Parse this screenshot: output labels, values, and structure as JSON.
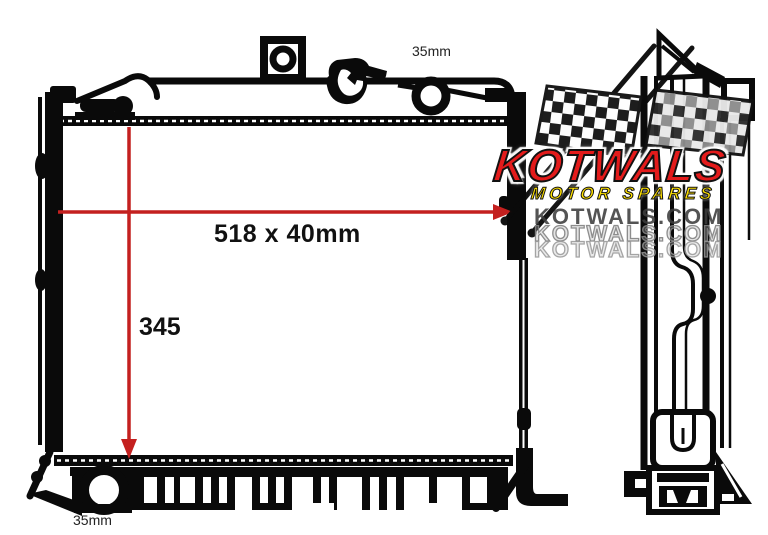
{
  "page": {
    "background": "#ffffff"
  },
  "diagram": {
    "subject": "Radiator technical line drawing, front and side views",
    "labels": {
      "core_size": "518 x 40mm",
      "core_height": "345",
      "top_port_diameter": "35mm",
      "bottom_port_diameter": "35mm"
    },
    "colors": {
      "dimension_arrow": "#c4201f",
      "linework": "#0a0a0a",
      "background": "#ffffff"
    }
  },
  "watermark": {
    "brand": "KOTWALS",
    "tagline": "MOTOR SPARES",
    "website_line1": "KOTWALS.COM",
    "website_line2": "KOTWALS.COM",
    "website_line3": "KOTWALS.COM",
    "brand_color": "#e31b1b",
    "tagline_color": "#ffe100"
  }
}
